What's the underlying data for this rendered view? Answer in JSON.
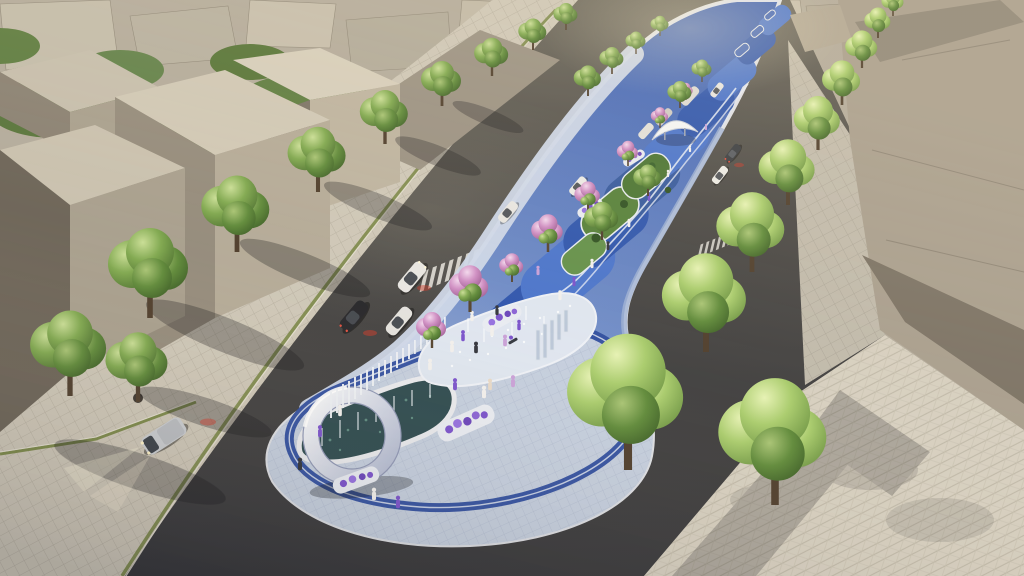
{
  "meta": {
    "type": "3d-architectural-rendering",
    "view": "aerial oblique, looking down a city avenue toward a hazy horizon",
    "time_of_day": "dusk, warm low sun from upper left, some headlights on",
    "description": "Concept render of a linear 'blue ribbon' median park running along an urban avenue. The near rounded terminus plaza holds a white ring arch standing in a dark pebble fountain bed ringed by navy paving bands, beside a dry-jet splash plaza full of pedestrians and white planters of purple flowers. The park continues into the distance as a painted blue ground mural with white curving lines, pink flowering trees, lawn gardens, a small white canopy pavilion and white picket screens. Asphalt roads with cars, a silver van with headlight beams, zebra crossings and paver sidewalks flank the park; untextured grey massing-model buildings and dense green tree canopy fill both sides to the horizon."
  },
  "palette": {
    "asphalt_near": "#37373a",
    "asphalt_far": "#6a665c",
    "sidewalk": "#cec7b8",
    "sidewalk_right": "#d7d0c1",
    "curb_green": "#74833f",
    "building_roof": "#d0c8b6",
    "building_face_lit": "#b4aa98",
    "building_face_mid": "#948b7c",
    "building_shadow": "#6c6458",
    "right_building": "#a89e8e",
    "park_base_near": "#bcc8de",
    "park_base_far": "#3c60b4",
    "park_navy": "#2c4b9e",
    "mural_blue": "#2e55ae",
    "mural_light": "#4a74cc",
    "walkway": "#cdd7e9",
    "pebble_bed": "#2d4a4f",
    "arch_white": "#ffffff",
    "arch_shade": "#a9b2cc",
    "tree_green": "#7fa84f",
    "tree_bright": "#a9cc6d",
    "bloom_pink": "#cf8ec4",
    "flower_purple": "#7a52cc",
    "lawn": "#55803a",
    "car_white": "#e8e6e2",
    "car_black": "#26262a",
    "van_silver": "#c9ccd0",
    "brake_red": "#d03828",
    "headlight": "#fdf4da"
  },
  "scene": {
    "park": {
      "label": "median linear park",
      "features": [
        "white ring arch monument",
        "dark pebble fountain bed with thin water jets",
        "dry splash-jet plaza",
        "navy banding around terminus",
        "blue ground mural with white curved lines",
        "white planters with purple flowers",
        "white picket screen fence",
        "lawn gardens with shrubs",
        "white canopy pavilion",
        "glass art panels"
      ]
    },
    "left_road": {
      "cars": [
        {
          "color": "white",
          "state": "driving"
        },
        {
          "color": "black",
          "state": "parked, brake glow"
        },
        {
          "color": "white",
          "state": "parked"
        },
        {
          "color": "white",
          "state": "distant"
        },
        {
          "color": "white",
          "state": "distant"
        },
        {
          "color": "white",
          "state": "parked distant row"
        }
      ],
      "crosswalks": 2
    },
    "right_road": {
      "cars": [
        {
          "color": "dark-grey",
          "state": "driving"
        },
        {
          "color": "white",
          "state": "driving"
        },
        {
          "color": "white",
          "state": "distant"
        }
      ],
      "crosswalks": 2,
      "scooter": 1
    },
    "corner_intersection": {
      "van": {
        "color": "silver",
        "headlights_on": true,
        "heading": "toward lower-left"
      },
      "plaza": "herringbone paver corner plaza with street tree"
    },
    "vegetation": {
      "street_trees_left": 8,
      "street_trees_right": 10,
      "flowering_pink_trees": 8,
      "park_green_trees": 4,
      "background_canopy_clusters": 10
    },
    "people": {
      "approx_count": 28,
      "activity": "strolling the promenade and gathering at the splash plaza"
    },
    "buildings": {
      "style": "untextured grey massing volumes",
      "left_cluster": 4,
      "right_cluster": 3,
      "background": "low-rise city blocks to horizon"
    }
  }
}
